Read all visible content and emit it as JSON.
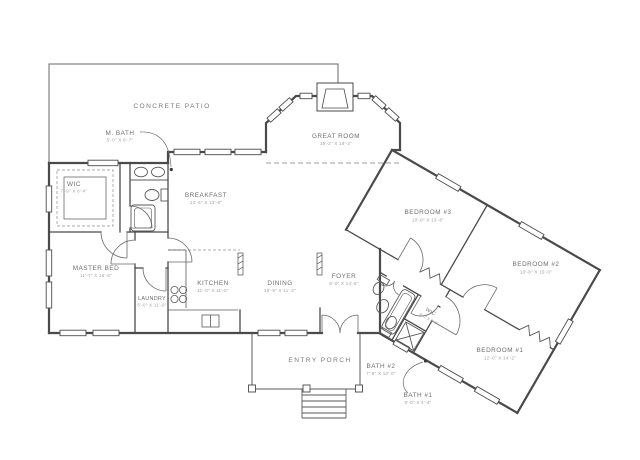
{
  "drawing": {
    "title": "residential floor plan",
    "background_color": "#ffffff",
    "wall_color": "#4a4a4a",
    "label_color": "#6f6f6f",
    "dim_color": "#9d9d9d"
  },
  "areas": {
    "patio": {
      "label": "CONCRETE PATIO"
    },
    "porch": {
      "label": "ENTRY PORCH"
    }
  },
  "rooms": [
    {
      "name": "M. BATH",
      "dims": "5'-0\" X 8'-7\""
    },
    {
      "name": "WIC",
      "dims": "7'-9\" X 6'-4\""
    },
    {
      "name": "BREAKFAST",
      "dims": "13'-6\" X 13'-6\""
    },
    {
      "name": "GREAT ROOM",
      "dims": "19'-2\" X 19'-2\""
    },
    {
      "name": "MASTER BED",
      "dims": "11'-7\" X 16'-6\""
    },
    {
      "name": "LAUNDRY",
      "dims": "5'-0\" X 11'-0\""
    },
    {
      "name": "KITCHEN",
      "dims": "11'-0\" X 11'-0\""
    },
    {
      "name": "DINING",
      "dims": "10'-9\" X 11'-2\""
    },
    {
      "name": "FOYER",
      "dims": "9'-0\" X 14'-6\""
    },
    {
      "name": "BEDROOM #3",
      "dims": "10'-8\" X 13'-8\""
    },
    {
      "name": "BEDROOM #2",
      "dims": "10'-8\" X 15'-0\""
    },
    {
      "name": "BEDROOM #1",
      "dims": "12'-0\" X 14'-2\""
    },
    {
      "name": "BATH #2",
      "dims": "7'-8\" X 10'-0\""
    },
    {
      "name": "BATH #1",
      "dims": "8'-0\" X 4'-4\""
    },
    {
      "name": "WIC",
      "dims": "6'-0\" X 6'-0\""
    }
  ]
}
